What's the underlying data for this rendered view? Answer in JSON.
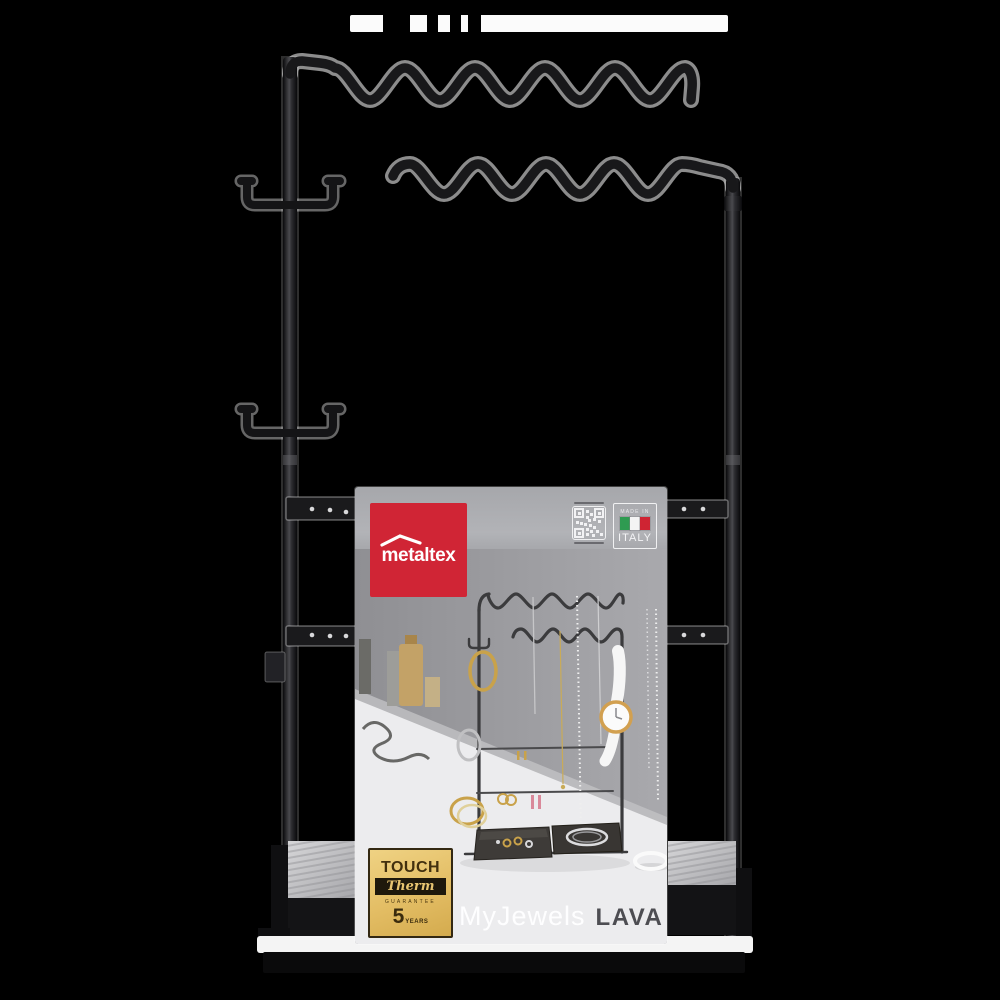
{
  "canvas": {
    "background": "#000000"
  },
  "stand": {
    "frame_color": "#18181a",
    "parts": [
      "top-wavy-rail",
      "lower-wavy-rail",
      "left-pole",
      "right-pole",
      "hook-arm-upper",
      "hook-arm-lower",
      "mounting-bars",
      "felt-tray-base"
    ]
  },
  "card": {
    "background_top": "#a6a7ab",
    "background_bottom": "#d7d7d9",
    "brand": {
      "label": "metaltex",
      "bg": "#d02535",
      "text_color": "#ffffff",
      "icon": "roof-icon"
    },
    "qr": {
      "icon": "qr-code-icon"
    },
    "made_in": {
      "line1": "MADE IN",
      "country": "ITALY",
      "flag_icon": "italy-flag-icon",
      "flag_colors": [
        "#2f9b51",
        "#f4f4f4",
        "#cf2433"
      ]
    },
    "guarantee": {
      "touch": "TOUCH",
      "therm": "Therm",
      "guarantee_word": "GUARANTEE",
      "number": "5",
      "years": "YEARS",
      "bg": "#e3bd64"
    },
    "product_name": {
      "primary": "MyJewels",
      "secondary": "LAVA"
    }
  }
}
